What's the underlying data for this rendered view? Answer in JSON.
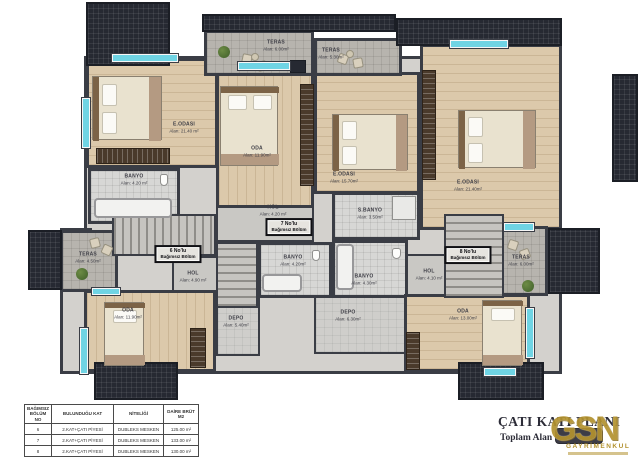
{
  "colors": {
    "wall": "#3a3d45",
    "wood_floor": "#dcc9ab",
    "window_glass": "#6fd4e4",
    "roof_hatch": "#262932",
    "logo_gold": "#b3922f"
  },
  "plan": {
    "unit_boxes": [
      {
        "line1": "6 No'lu",
        "line2": "Bağımsız Bölüm"
      },
      {
        "line1": "7 No'lu",
        "line2": "Bağımsız Bölüm"
      },
      {
        "line1": "8 No'lu",
        "line2": "Bağımsız Bölüm"
      }
    ],
    "rooms": [
      {
        "name": "E.ODASI",
        "area": "Alan: 21.40 m²"
      },
      {
        "name": "BANYO",
        "area": "Alan: 4.20 m²"
      },
      {
        "name": "TERAS",
        "area": "Alan: 4.50m²"
      },
      {
        "name": "HOL",
        "area": "Alan: 4.90 m²"
      },
      {
        "name": "ODA",
        "area": "Alan: 11.90m²"
      },
      {
        "name": "DEPO",
        "area": "Alan: 5.40m²"
      },
      {
        "name": "ODA",
        "area": "Alan: 11.90m²"
      },
      {
        "name": "E.ODASI",
        "area": "Alan: 15.70m²"
      },
      {
        "name": "S.BANYO",
        "area": "Alan: 3.50m²"
      },
      {
        "name": "HOL",
        "area": "Alan: 4.20 m²"
      },
      {
        "name": "BANYO",
        "area": "Alan: 4.20m²"
      },
      {
        "name": "DEPO",
        "area": "Alan: 6.30m²"
      },
      {
        "name": "TERAS",
        "area": "Alan: 6.00m²"
      },
      {
        "name": "TERAS",
        "area": "Alan: 5.30m²"
      },
      {
        "name": "E.ODASI",
        "area": "Alan: 21.40m²"
      },
      {
        "name": "BANYO",
        "area": "Alan: 4.30m²"
      },
      {
        "name": "HOL",
        "area": "Alan: 4.10 m²"
      },
      {
        "name": "ODA",
        "area": "Alan: 13.00m²"
      },
      {
        "name": "TERAS",
        "area": "Alan: 6.00m²"
      }
    ]
  },
  "table": {
    "headers": [
      "BAĞIMSIZ BÖLÜM NO",
      "BULUNDUĞU KAT",
      "NİTELİĞİ",
      "DAİRE BRÜT M2"
    ],
    "rows": [
      [
        "6",
        "2.KAT+ÇATI PİYESİ",
        "DUBLEKS MESKEN",
        "125.00 m²"
      ],
      [
        "7",
        "2.KAT+ÇATI PİYESİ",
        "DUBLEKS MESKEN",
        "133.00 m²"
      ],
      [
        "8",
        "2.KAT+ÇATI PİYESİ",
        "DUBLEKS MESKEN",
        "130.00 m²"
      ]
    ]
  },
  "title_block": {
    "title": "ÇATI KATI PLANI",
    "subtitle_label": "Toplam Alan =",
    "obscured_value": "",
    "logo": {
      "text": "GSN",
      "subtext": "GAYRİMENKUL"
    }
  }
}
